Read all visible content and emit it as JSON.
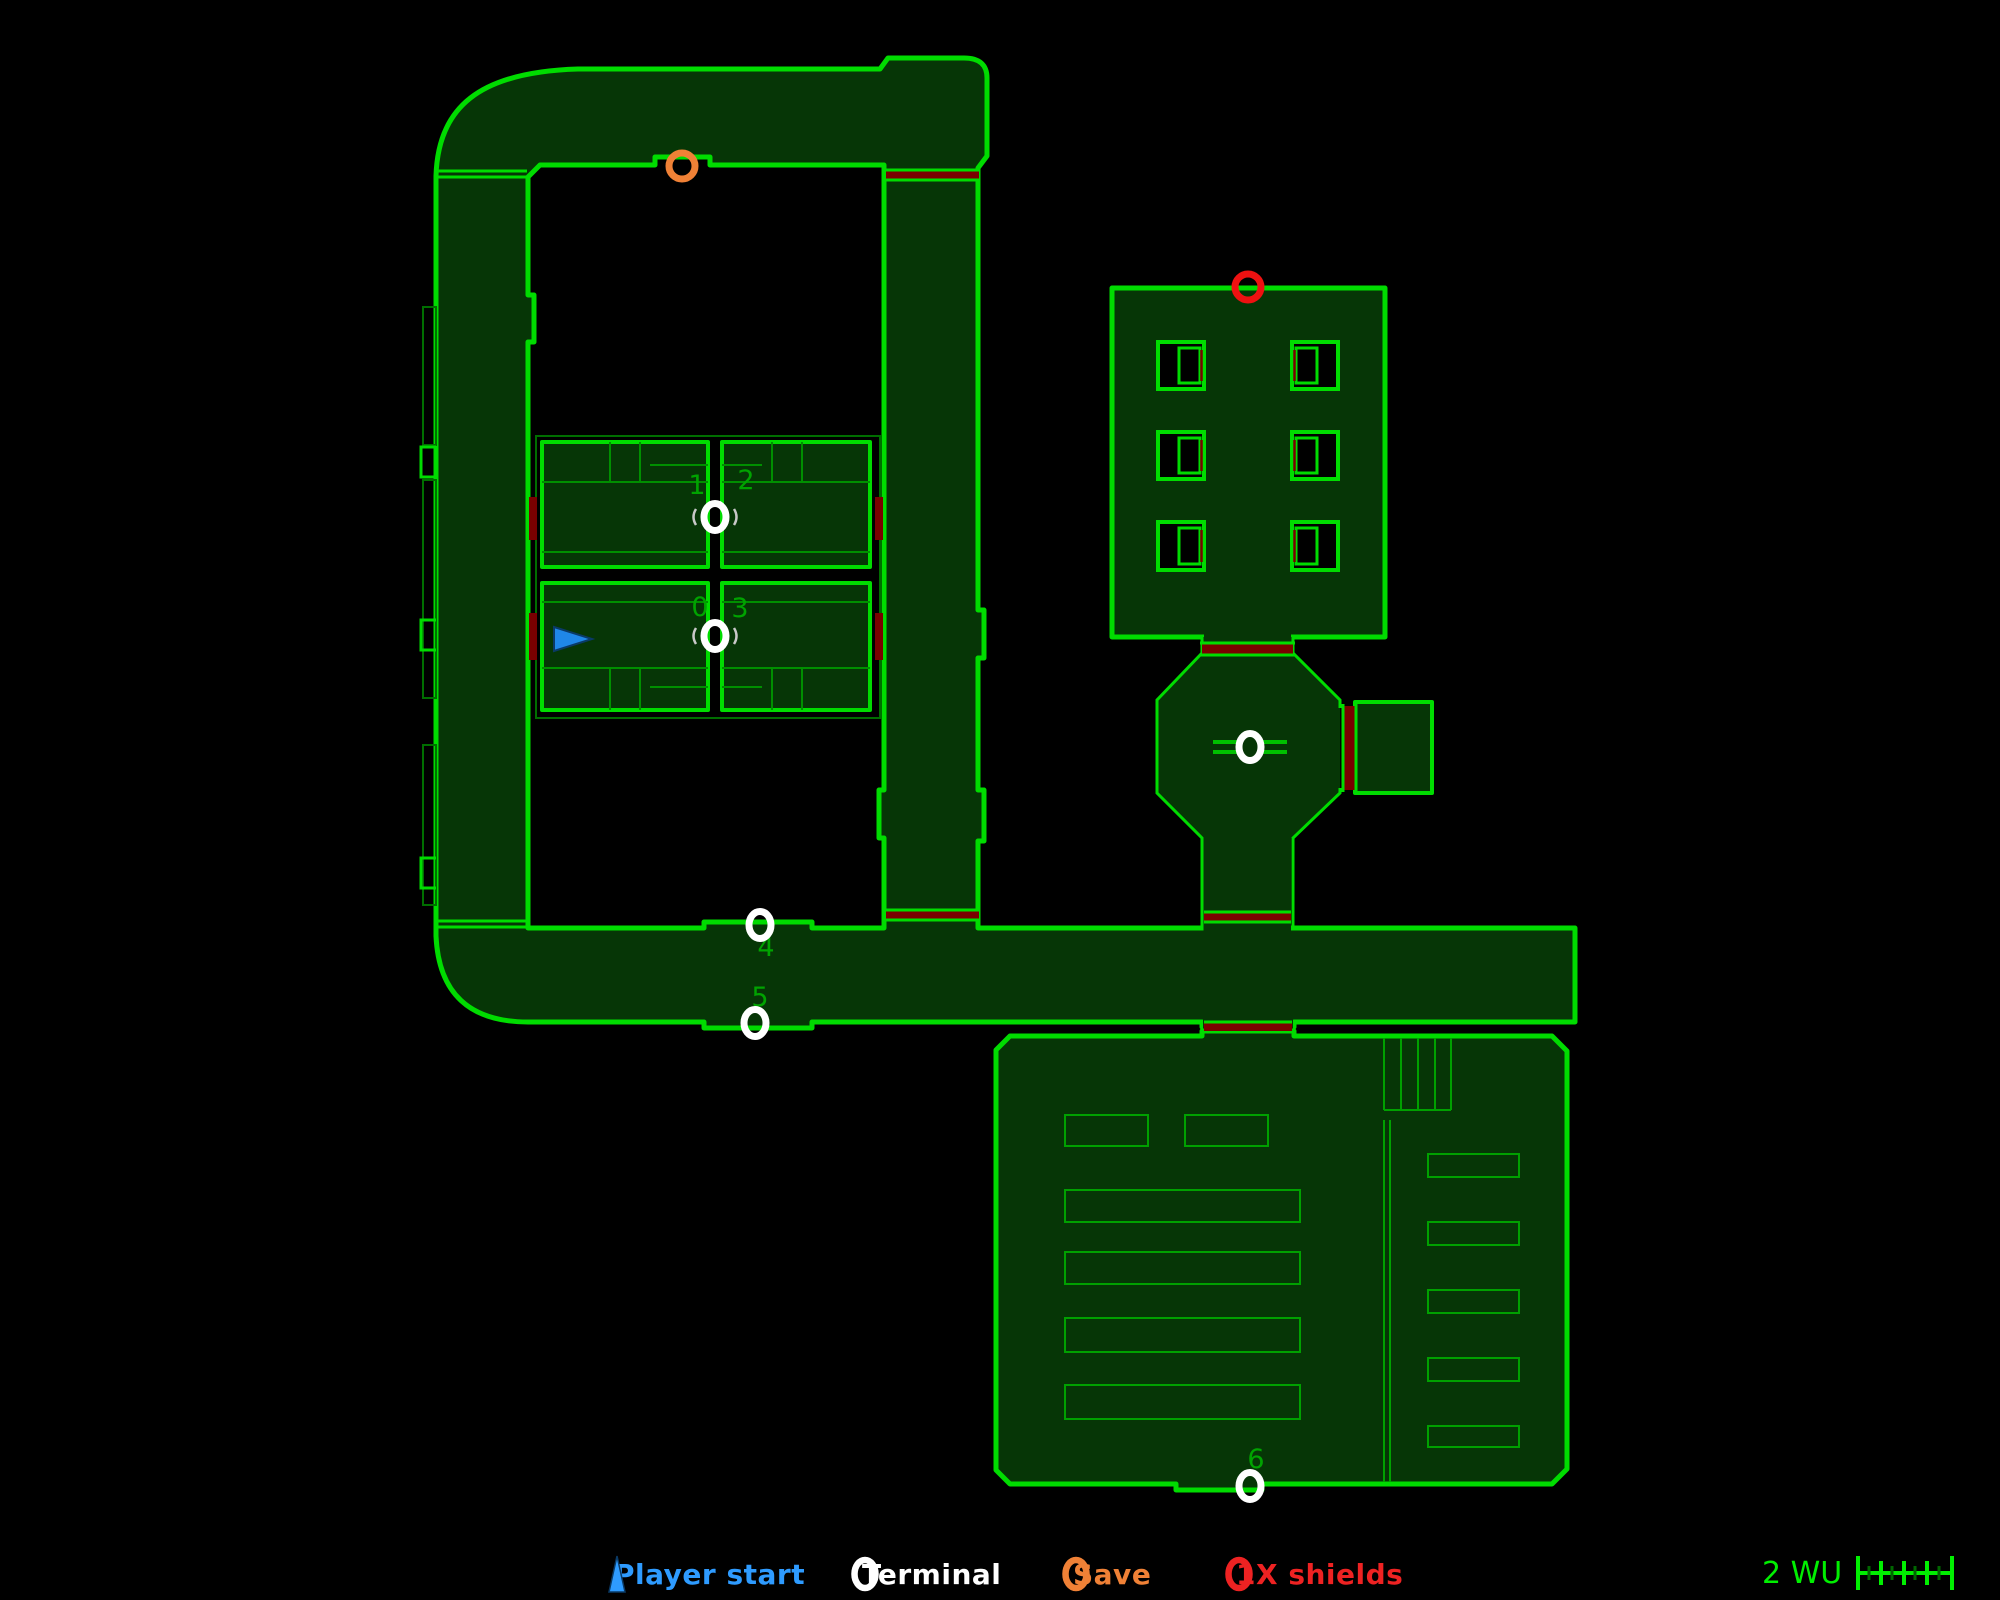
{
  "legend": {
    "items": [
      {
        "name": "player-start",
        "label": "Player start",
        "marker": "triangle",
        "color": "#2e9bff",
        "x": 600
      },
      {
        "name": "terminal",
        "label": "Terminal",
        "marker": "ring",
        "color": "#ffffff",
        "x": 848
      },
      {
        "name": "save",
        "label": "Save",
        "marker": "ring",
        "color": "#f08136",
        "x": 1059
      },
      {
        "name": "shields",
        "label": "1X shields",
        "marker": "ring",
        "color": "#ee2222",
        "x": 1222
      }
    ]
  },
  "scale": {
    "label": "2 WU",
    "ruler_color": "#00ef00",
    "minor_tick_color": "#006600"
  },
  "map": {
    "colors": {
      "background": "#000000",
      "floor_fill": "#063606",
      "wall_green": "#00dc00",
      "detail_green": "#008f00",
      "door_red": "#7a0000",
      "terminal_white": "#ffffff",
      "save_orange": "#f08136",
      "shield_red": "#ee1111",
      "player_blue": "#1f87e8",
      "label_green": "#00a300"
    },
    "terminals": [
      {
        "style": "eye",
        "cx": 715,
        "cy": 517
      },
      {
        "style": "eye",
        "cx": 715,
        "cy": 636
      },
      {
        "style": "bars",
        "cx": 1250,
        "cy": 747
      },
      {
        "style": "plain",
        "cx": 760,
        "cy": 925
      },
      {
        "style": "plain",
        "cx": 755,
        "cy": 1023
      },
      {
        "style": "plain",
        "cx": 1250,
        "cy": 1486
      }
    ],
    "terminal_numbers": [
      {
        "t": "0",
        "x": 700,
        "y": 616
      },
      {
        "t": "1",
        "x": 697,
        "y": 494
      },
      {
        "t": "2",
        "x": 746,
        "y": 489
      },
      {
        "t": "3",
        "x": 740,
        "y": 617
      },
      {
        "t": "4",
        "x": 766,
        "y": 956
      },
      {
        "t": "5",
        "x": 760,
        "y": 1006
      },
      {
        "t": "6",
        "x": 1256,
        "y": 1468
      }
    ],
    "save_marker": {
      "cx": 682,
      "cy": 166
    },
    "shield_marker": {
      "cx": 1248,
      "cy": 287
    },
    "player_start": {
      "cx": 572,
      "cy": 639,
      "direction": "right"
    }
  }
}
